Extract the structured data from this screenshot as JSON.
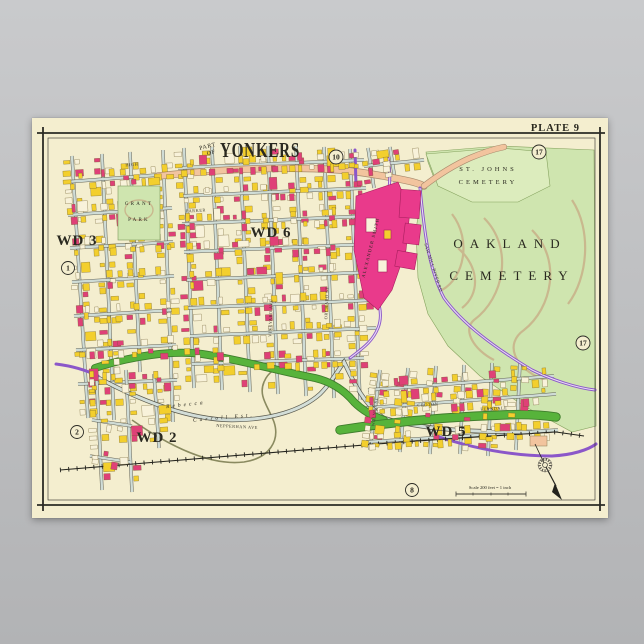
{
  "poster": {
    "plate_label": "PLATE 9",
    "title_prefix_1": "PART",
    "title_prefix_2": "OF",
    "title": "YONKERS"
  },
  "map": {
    "wards": {
      "wd3": "WD 3",
      "wd6": "WD 6",
      "wd2": "WD 2",
      "wd5": "WD 5"
    },
    "places": {
      "grant_park": [
        "GRANT",
        "PARK"
      ],
      "st_johns": [
        "ST. JOHNS",
        "CEMETERY"
      ],
      "oakland": [
        "OAKLAND",
        "CEMETERY"
      ],
      "estate": [
        "Rebecca",
        "Carroll Est."
      ],
      "mill": "ALEXANDER SMITH"
    },
    "streets": {
      "high": "HIGH",
      "parker": "PARKER",
      "vineyard": "VINEYARD AVE",
      "orchard": "ORCHARD ST",
      "croton": "CROTON",
      "ferndale": "FERNDALE",
      "walnut": "WALNUT ST",
      "nepperhan": "NEPPERHAN AVE",
      "saw_mill": "SAW MILL RIVER RD"
    },
    "circles": {
      "c1": "1",
      "c2": "2",
      "c8": "8",
      "c10": "10",
      "c17a": "17",
      "c17b": "17"
    },
    "scale_text": "Scale 200 feet = 1 inch"
  },
  "colors": {
    "paper": "#f4eecf",
    "cemetery_green": "#cfe5af",
    "st_johns_green": "#dcecbd",
    "band_green": "#57b33b",
    "purple": "#8b57c9",
    "salmon": "#f2c49e",
    "yellow": "#f3cf2d",
    "pink": "#df4077",
    "mill_pink": "#e93a8b",
    "street_wash": "#cfdcd6",
    "path_tan": "#c9b88e",
    "ink": "#2b2b25"
  }
}
